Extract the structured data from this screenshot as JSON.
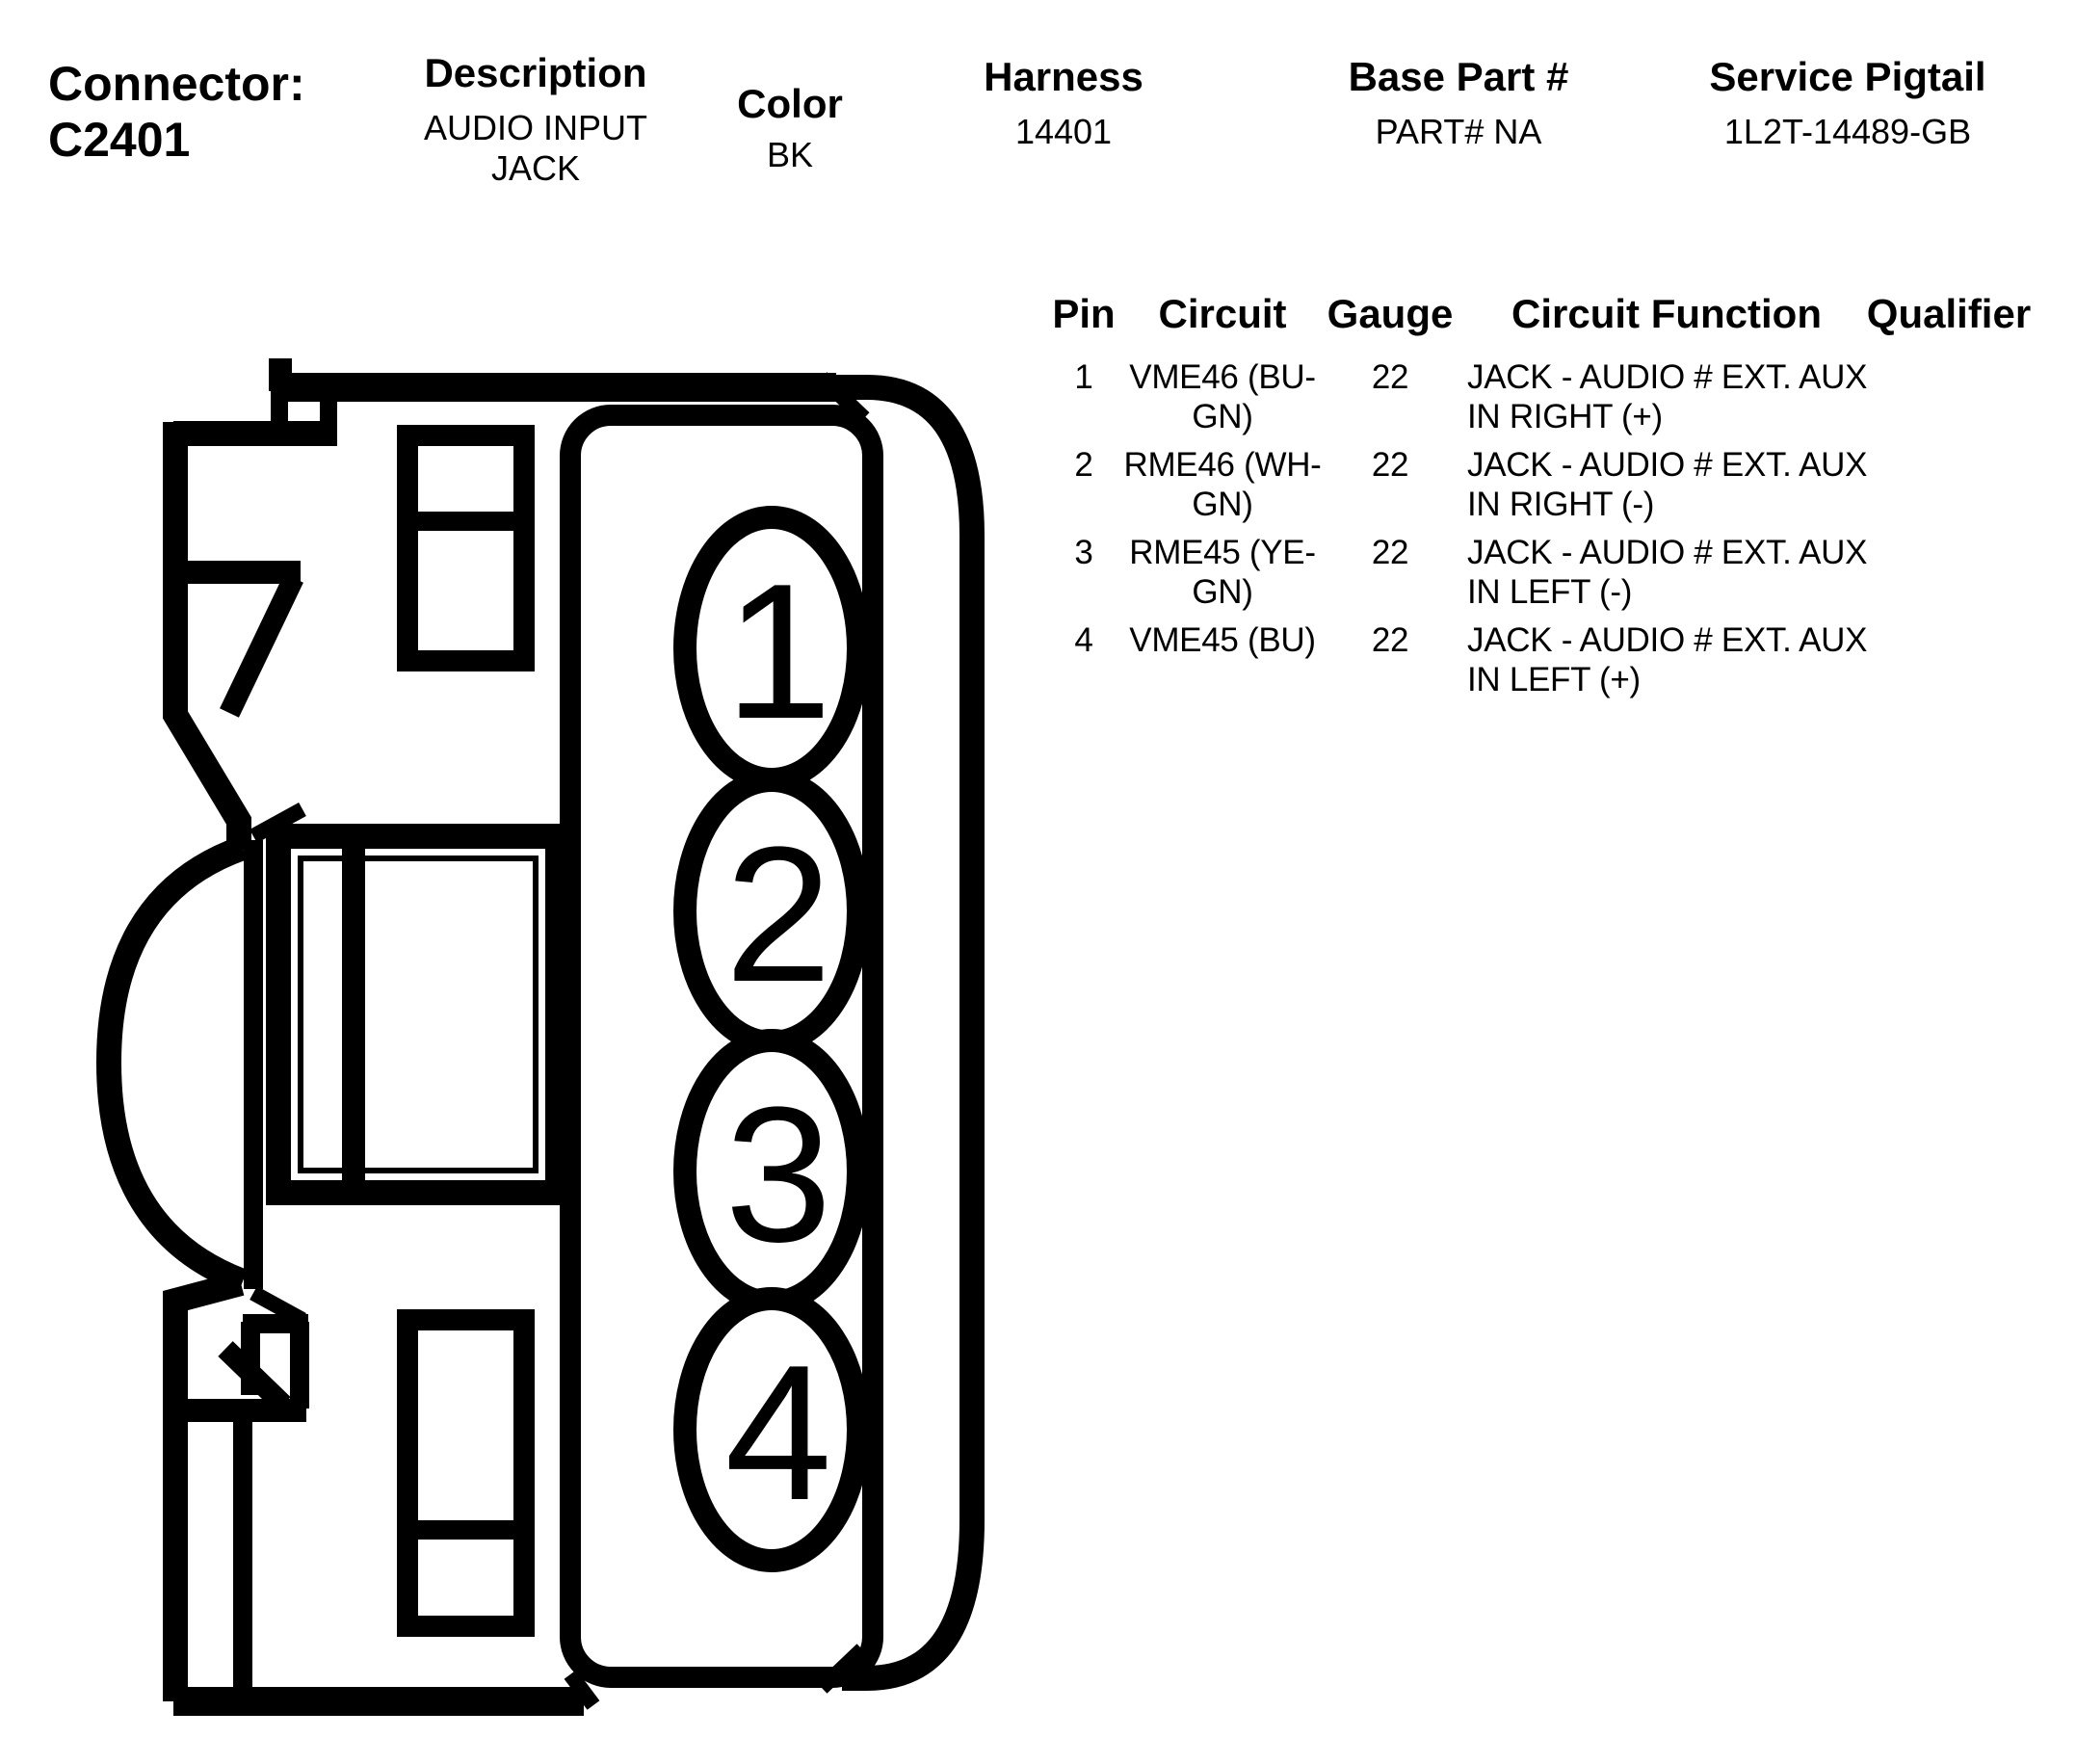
{
  "header": {
    "connector_label": "Connector:",
    "connector_value": "C2401",
    "fields": [
      {
        "label": "Description",
        "lines": [
          "AUDIO INPUT",
          "JACK"
        ]
      },
      {
        "label": "Color",
        "lines": [
          "BK"
        ]
      },
      {
        "label": "Harness",
        "lines": [
          "14401"
        ]
      },
      {
        "label": "Base Part #",
        "lines": [
          "PART# NA"
        ]
      },
      {
        "label": "Service Pigtail",
        "lines": [
          "1L2T-14489-GB"
        ]
      }
    ]
  },
  "pin_table": {
    "headers": [
      "Pin",
      "Circuit",
      "Gauge",
      "Circuit Function",
      "Qualifier"
    ],
    "rows": [
      {
        "pin": "1",
        "circuit": [
          "VME46 (BU-",
          "GN)"
        ],
        "gauge": "22",
        "function": [
          "JACK - AUDIO # EXT. AUX",
          "IN RIGHT (+)"
        ],
        "qualifier": ""
      },
      {
        "pin": "2",
        "circuit": [
          "RME46 (WH-",
          "GN)"
        ],
        "gauge": "22",
        "function": [
          "JACK - AUDIO # EXT. AUX",
          "IN RIGHT (-)"
        ],
        "qualifier": ""
      },
      {
        "pin": "3",
        "circuit": [
          "RME45 (YE-",
          "GN)"
        ],
        "gauge": "22",
        "function": [
          "JACK - AUDIO # EXT. AUX",
          "IN LEFT (-)"
        ],
        "qualifier": ""
      },
      {
        "pin": "4",
        "circuit": [
          "VME45 (BU)"
        ],
        "gauge": "22",
        "function": [
          "JACK - AUDIO # EXT. AUX",
          "IN LEFT (+)"
        ],
        "qualifier": ""
      }
    ]
  },
  "diagram": {
    "pins": [
      "1",
      "2",
      "3",
      "4"
    ],
    "line_color": "#000000"
  }
}
